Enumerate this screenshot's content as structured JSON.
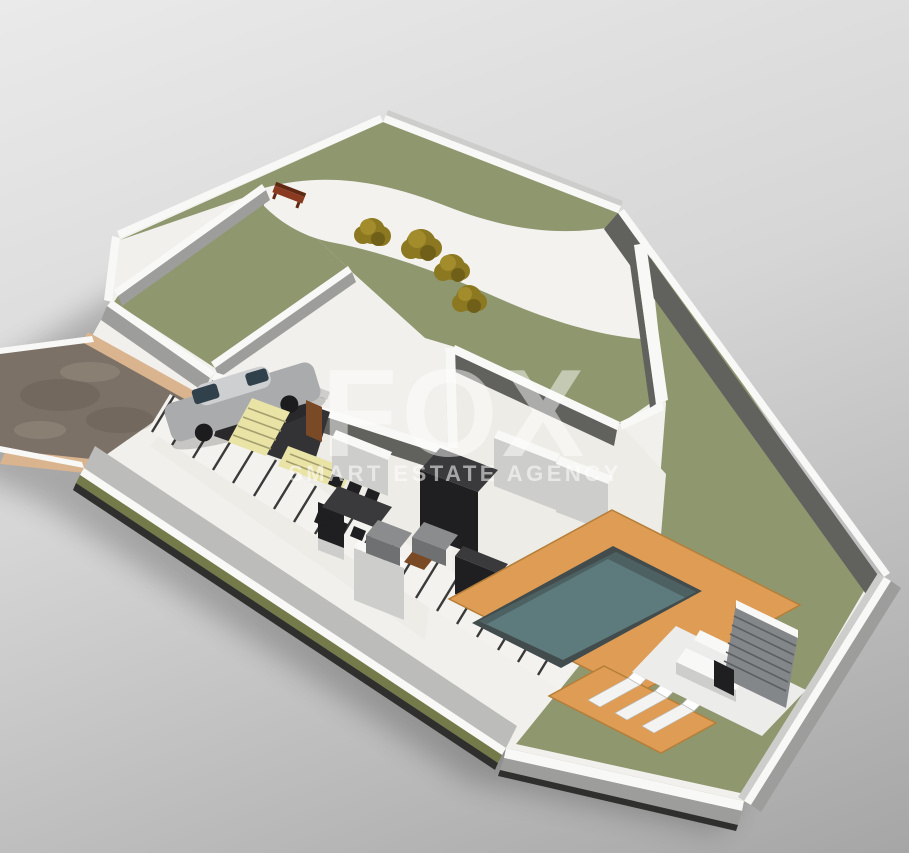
{
  "meta": {
    "type": "3d-floor-plan-render",
    "view": "isometric",
    "subject": "single-storey villa plot with garden, driveway, carport and swimming pool"
  },
  "watermark": {
    "brand": "FOX",
    "tagline": "SMART ESTATE AGENCY"
  },
  "scene": {
    "features": [
      "irregular walled plot",
      "upper landscaped garden with curved white path",
      "four olive shrubs",
      "garden bench",
      "gravel driveway with tan curbs",
      "parked silver car under carport",
      "L-shaped yellow staircase",
      "interior rooms with dark wardrobes and kitchen units",
      "dining table with six chairs",
      "two grey sofas with brown coffee table",
      "stepping-stone walkway along boundary wall",
      "orange timber pool deck",
      "rectangular swimming pool",
      "three sun loungers on deck extension",
      "outdoor bar with slatted screen wall",
      "large lawn on east side"
    ],
    "counts": {
      "bushes": 4,
      "sun_loungers": 3,
      "cars": 1,
      "pools": 1
    }
  },
  "colors": {
    "bg_top": "#eaeaea",
    "bg_mid": "#d6d6d6",
    "bg_bottom": "#a6a6a6",
    "base_floor": "#f1f0ec",
    "interior_floor": "#edece7",
    "path_white": "#f3f2ee",
    "wall_top": "#f8f8f6",
    "wall_face_light": "#cdcdcb",
    "wall_face_mid": "#9d9d9b",
    "wall_face_dark": "#61615e",
    "apron": "#bcbcba",
    "ground_edge": "#2f2f2d",
    "lawn": "#8f976f",
    "hedge": "#747a49",
    "driveway": "#7c7166",
    "curb": "#d9b48e",
    "deck": "#de9c55",
    "deck_shade": "#b57f39",
    "pool_rim": "#424c4d",
    "pool_water": "#5d7b7d",
    "stair": "#e9e3a6",
    "stair_line": "#a59e6e",
    "door": "#7a4a26",
    "dark_furniture": "#1f1f21",
    "dark_top": "#3a3a3c",
    "sofa": "#8b8c8e",
    "sofa_face": "#6f7072",
    "garage_dark": "#333335",
    "car_body": "#a9abad",
    "car_roof": "#cdcfd1",
    "car_glass": "#31414c",
    "wheel": "#1c1c1e",
    "bench_wood": "#8a3a1e",
    "bench_dark": "#5e2812",
    "bush": "#8c7820",
    "bush_light": "#a28c2b",
    "bush_dark": "#6f5f18",
    "lounger": "#f3f3f1",
    "pad": "#ececea",
    "bar_slat": "#84878a",
    "bar_slat_line": "#5c5f62",
    "rung": "#3a3a3a",
    "watermark": "#ffffff",
    "shadow": "#000000"
  }
}
